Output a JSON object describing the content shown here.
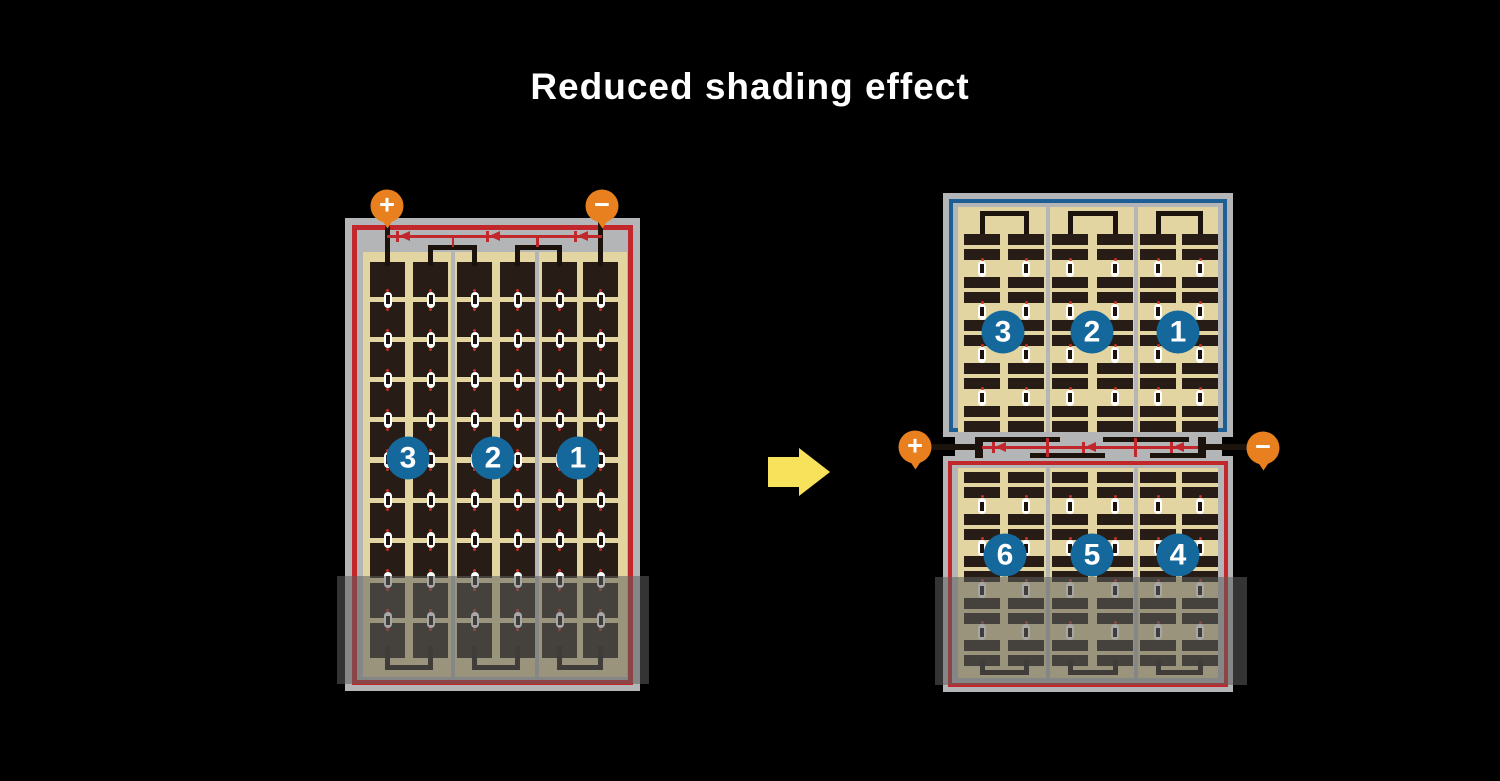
{
  "title": "Reduced shading effect",
  "colors": {
    "background": "#000000",
    "frame_gray": "#b4b5b7",
    "module_red": "#c1272b",
    "module_blue": "#1d5f95",
    "cell_background_tan": "#e3d5a2",
    "cell_dark": "#271d16",
    "wire_black": "#1c130d",
    "badge_blue": "#15689c",
    "terminal_orange": "#e8801f",
    "arrow_yellow": "#f8e25c",
    "diode_red": "#c1272b",
    "connector_white": "#ffffff",
    "connector_dot_red": "#c43125",
    "shade": "rgba(95,95,95,0.55)"
  },
  "left_module": {
    "description": "conventional full-cell module with shaded bottom rows",
    "terminal_positive": "+",
    "terminal_negative": "−",
    "string_badges": [
      "3",
      "2",
      "1"
    ],
    "grid": {
      "strings": 3,
      "columns_per_string": 2,
      "rows": 10,
      "shaded_rows": 2
    },
    "bypass_diodes": 3
  },
  "right_panel": {
    "description": "half-cell module split into independent top and bottom halves",
    "terminal_positive": "+",
    "terminal_negative": "−",
    "top_module": {
      "string_badges": [
        "3",
        "2",
        "1"
      ],
      "grid": {
        "strings": 3,
        "columns_per_string": 2,
        "strip_rows": 10
      }
    },
    "bottom_module": {
      "string_badges": [
        "6",
        "5",
        "4"
      ],
      "grid": {
        "strings": 3,
        "columns_per_string": 2,
        "strip_rows": 10
      }
    },
    "bypass_diodes": 3
  }
}
